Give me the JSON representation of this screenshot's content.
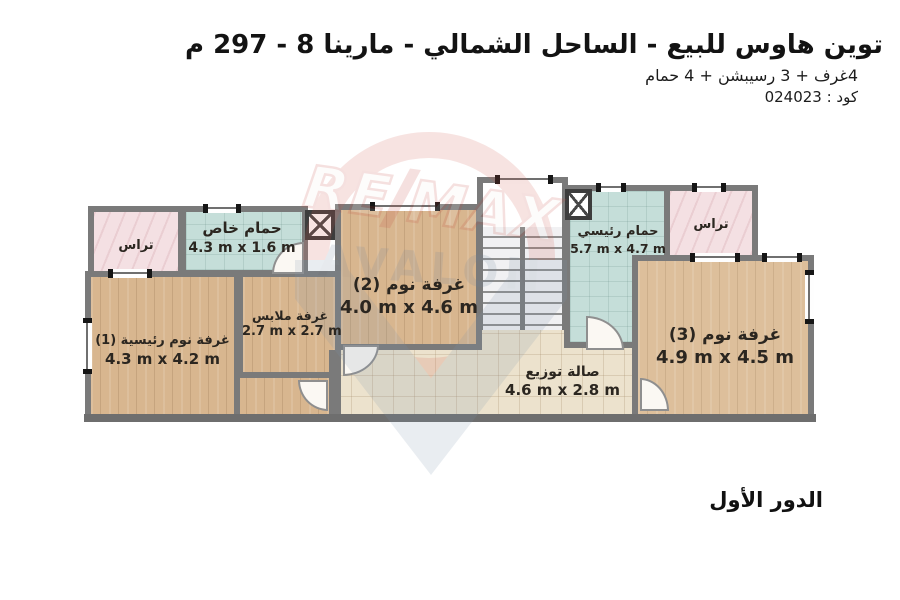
{
  "header": {
    "title": "توين هاوس للبيع - الساحل الشمالي - مارينا 8 - 297 م",
    "subtitle": "4غرف + 3 رسيبشن + 4 حمام",
    "code": "كود : 024023"
  },
  "floor_label": "الدور الأول",
  "rooms": {
    "terrace_left": {
      "name": "تراس"
    },
    "private_bath": {
      "name": "حمام خاص",
      "dims": "4.3 m x 1.6 m"
    },
    "master_bedroom": {
      "name": "غرفة نوم رئيسية (1)",
      "dims": "4.3 m x 4.2 m"
    },
    "dressing": {
      "name": "غرفة ملابس",
      "dims": "2.7 m x 2.7 m"
    },
    "bedroom_2": {
      "name": "غرفة نوم (2)",
      "dims": "4.0 m x 4.6 m"
    },
    "main_bath": {
      "name": "حمام رئيسي",
      "dims": "5.7 m x 4.7 m"
    },
    "terrace_right": {
      "name": "تراس"
    },
    "bedroom_3": {
      "name": "غرفة نوم (3)",
      "dims": "4.9 m x 4.5 m"
    },
    "hall": {
      "name": "صالة توزيع",
      "dims": "4.6 m x 2.8 m"
    }
  },
  "watermark": {
    "brand_left": "RE",
    "brand_right": "MAX",
    "subtext": "AVALON"
  },
  "colors": {
    "accent_red": "#c5473c",
    "accent_blue": "#70849c",
    "wood": "#d8b68f",
    "tile_teal": "#c5ded9",
    "terrace_pink": "#f4e0e3",
    "hall_beige": "#ece2cd",
    "wall_gray": "#7a7a7a"
  }
}
